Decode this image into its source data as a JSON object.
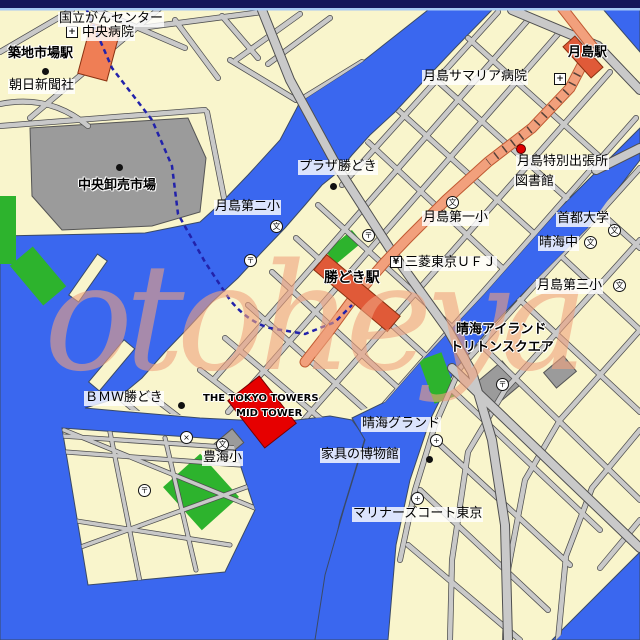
{
  "colors": {
    "water": "#3A67EF",
    "land": "#F9F5CC",
    "road": "#C9C9C9",
    "road_edge": "#4F4F4F",
    "orange_road": "#F2A07C",
    "orange_edge": "#C05A32",
    "station_light": "#EF7E55",
    "station_dark": "#E05A38",
    "park": "#2DB32D",
    "building_gray": "#9B9B9B",
    "building_red": "#E60000",
    "subway_line": "#2222AA",
    "watermark": "#F0A27E",
    "topbar": "#15155A",
    "topbar_accent": "#A6C8F4"
  },
  "watermark": {
    "text": "otoheya"
  },
  "labels": [
    {
      "id": "kokuritsu-gan-center",
      "text": "国立がんセンター",
      "x": 58,
      "y": 12,
      "style": "box"
    },
    {
      "id": "chuo-byoin",
      "text": "中央病院",
      "x": 81,
      "y": 26,
      "style": "box"
    },
    {
      "id": "tsukijishijo-station",
      "text": "築地市場駅",
      "x": 8,
      "y": 47,
      "style": "halo bold"
    },
    {
      "id": "asahi-shimbun",
      "text": "朝日新聞社",
      "x": 8,
      "y": 79,
      "style": "box"
    },
    {
      "id": "chuo-oroshiuri-ichiba",
      "text": "中央卸売市場",
      "x": 78,
      "y": 179,
      "style": "halo bold"
    },
    {
      "id": "tsukishima-station",
      "text": "月島駅",
      "x": 568,
      "y": 46,
      "style": "halo bold"
    },
    {
      "id": "tsukishima-samaria-byoin",
      "text": "月島サマリア病院",
      "x": 422,
      "y": 70,
      "style": "box"
    },
    {
      "id": "tsukishima-tokubetsu-shucchojo",
      "text": "月島特別出張所",
      "x": 516,
      "y": 155,
      "style": "box"
    },
    {
      "id": "toshokan",
      "text": "図書館",
      "x": 514,
      "y": 175,
      "style": "box"
    },
    {
      "id": "plaza-kachidoki",
      "text": "プラザ勝どき",
      "x": 298,
      "y": 160,
      "style": "box"
    },
    {
      "id": "tsukishima-dai2-sho",
      "text": "月島第二小",
      "x": 214,
      "y": 200,
      "style": "box"
    },
    {
      "id": "tsukishima-dai1-sho",
      "text": "月島第一小",
      "x": 422,
      "y": 211,
      "style": "box"
    },
    {
      "id": "shuto-daigaku",
      "text": "首都大学",
      "x": 556,
      "y": 212,
      "style": "box"
    },
    {
      "id": "harumi-chu",
      "text": "晴海中",
      "x": 538,
      "y": 236,
      "style": "box"
    },
    {
      "id": "mitsubishi-tokyo-ufj",
      "text": "三菱東京ＵＦＪ",
      "x": 404,
      "y": 256,
      "style": "box"
    },
    {
      "id": "kachidoki-station",
      "text": "勝どき駅",
      "x": 324,
      "y": 271,
      "style": "halo bold",
      "size": 14
    },
    {
      "id": "tsukishima-dai3-sho",
      "text": "月島第三小",
      "x": 536,
      "y": 279,
      "style": "box"
    },
    {
      "id": "harumi-island",
      "text": "晴海アイランド",
      "x": 456,
      "y": 323,
      "style": "halo bold"
    },
    {
      "id": "triton-square",
      "text": "トリトンスクエア",
      "x": 450,
      "y": 341,
      "style": "halo bold"
    },
    {
      "id": "bmw-kachidoki",
      "text": "ＢＭＷ勝どき",
      "x": 84,
      "y": 391,
      "style": "box"
    },
    {
      "id": "tokyo-towers-line1",
      "text": "THE TOKYO TOWERS",
      "x": 203,
      "y": 393,
      "style": "halo bold",
      "size": 10
    },
    {
      "id": "tokyo-towers-line2",
      "text": "MID TOWER",
      "x": 236,
      "y": 408,
      "style": "halo bold",
      "size": 10
    },
    {
      "id": "harumi-ground",
      "text": "晴海グランド",
      "x": 361,
      "y": 417,
      "style": "box"
    },
    {
      "id": "kagu-no-hakubutsukan",
      "text": "家具の博物館",
      "x": 320,
      "y": 448,
      "style": "box"
    },
    {
      "id": "toyomi-sho",
      "text": "豊海小",
      "x": 202,
      "y": 451,
      "style": "box"
    },
    {
      "id": "mariners-court-tokyo",
      "text": "マリナーズコート東京",
      "x": 352,
      "y": 507,
      "style": "box"
    }
  ],
  "icon_glyphs": {
    "hospital": "+",
    "school": "文",
    "university": "文",
    "post": "〒",
    "koban": "×",
    "bank": "¥",
    "facility": "+",
    "dot": "",
    "red-dot": ""
  },
  "icons": [
    {
      "type": "hospital",
      "x": 66,
      "y": 26
    },
    {
      "type": "hospital",
      "x": 554,
      "y": 73
    },
    {
      "type": "red-dot",
      "x": 516,
      "y": 144
    },
    {
      "type": "dot",
      "x": 42,
      "y": 68
    },
    {
      "type": "dot",
      "x": 116,
      "y": 164
    },
    {
      "type": "dot",
      "x": 330,
      "y": 183
    },
    {
      "type": "dot",
      "x": 178,
      "y": 402
    },
    {
      "type": "dot",
      "x": 426,
      "y": 456
    },
    {
      "type": "school",
      "x": 270,
      "y": 220
    },
    {
      "type": "school",
      "x": 446,
      "y": 196
    },
    {
      "type": "university",
      "x": 608,
      "y": 224
    },
    {
      "type": "school",
      "x": 584,
      "y": 236
    },
    {
      "type": "school",
      "x": 613,
      "y": 279
    },
    {
      "type": "school",
      "x": 216,
      "y": 438
    },
    {
      "type": "post",
      "x": 244,
      "y": 254
    },
    {
      "type": "post",
      "x": 362,
      "y": 229
    },
    {
      "type": "post",
      "x": 496,
      "y": 378
    },
    {
      "type": "post",
      "x": 138,
      "y": 484
    },
    {
      "type": "koban",
      "x": 180,
      "y": 431
    },
    {
      "type": "bank",
      "x": 390,
      "y": 256
    },
    {
      "type": "facility",
      "x": 430,
      "y": 434
    },
    {
      "type": "facility",
      "x": 411,
      "y": 492
    }
  ]
}
